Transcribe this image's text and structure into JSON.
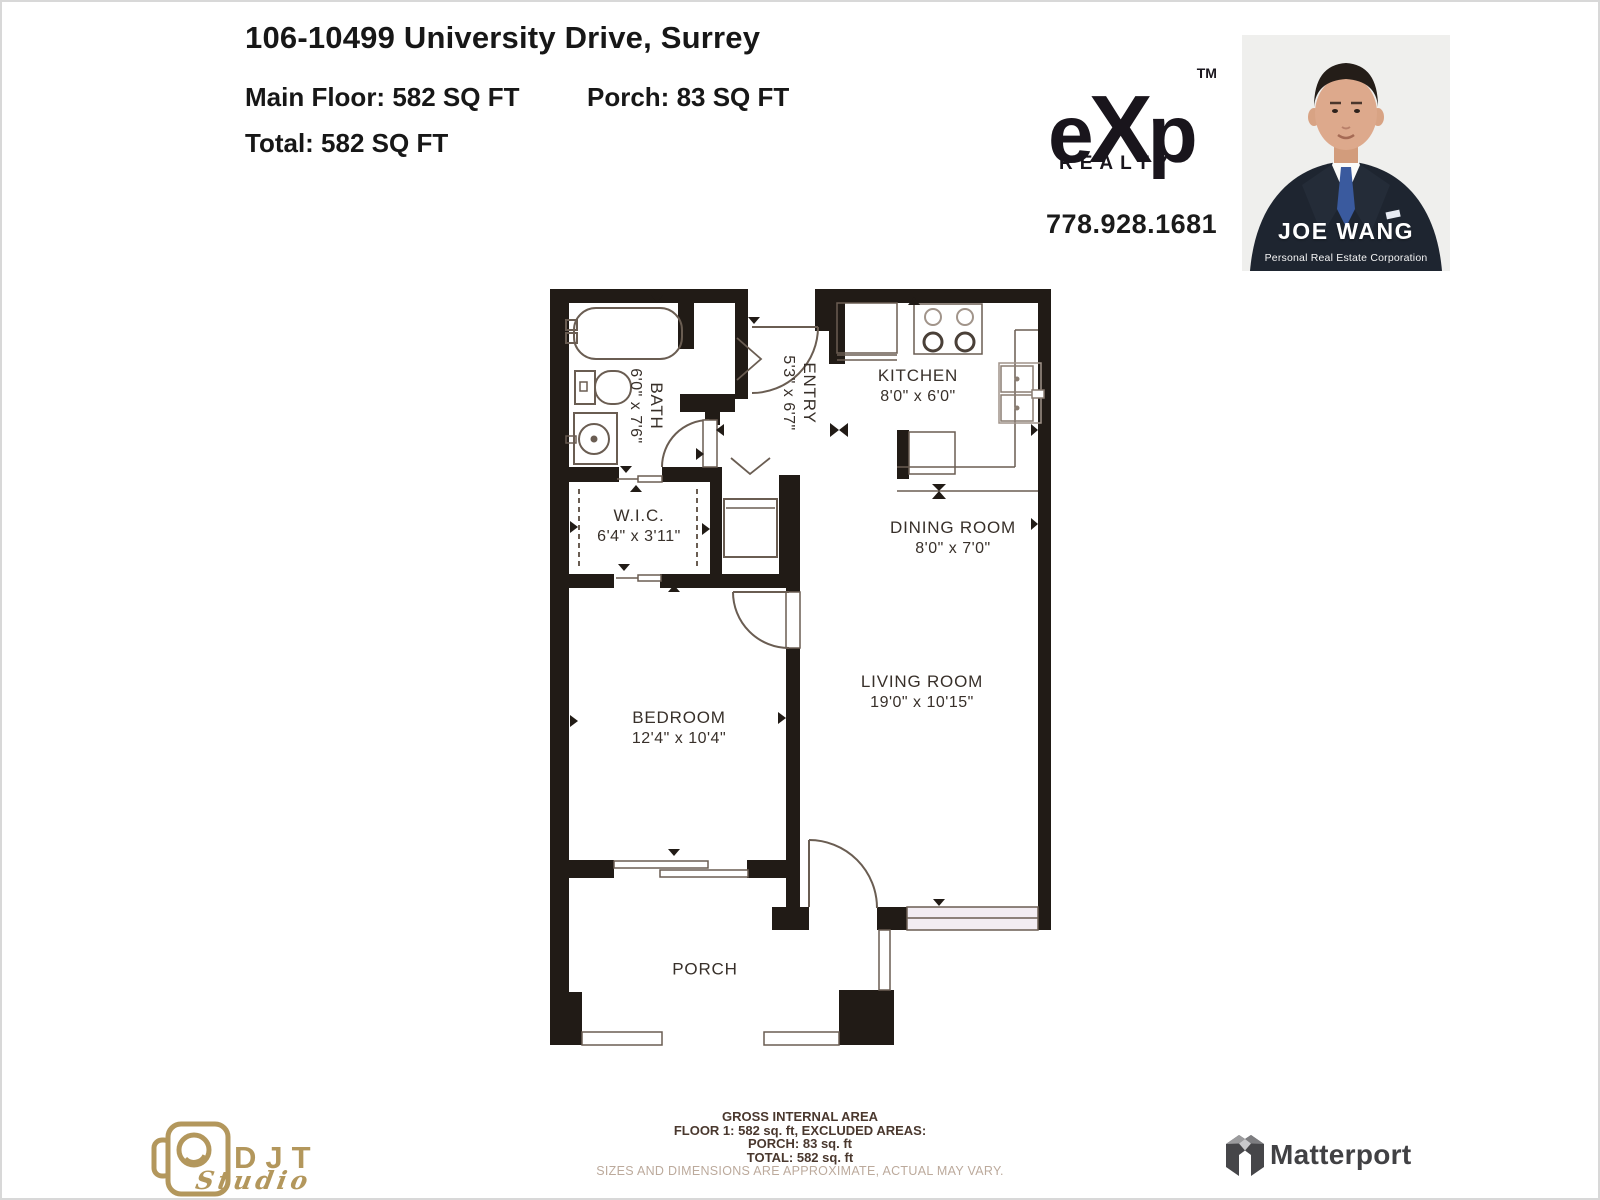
{
  "header": {
    "title": "106-10499 University Drive, Surrey",
    "main_floor": "Main Floor: 582 SQ FT",
    "porch": "Porch: 83 SQ FT",
    "total": "Total: 582 SQ FT"
  },
  "branding": {
    "exp": {
      "e": "e",
      "x": "X",
      "p": "p",
      "tm": "TM",
      "sub": "REALTY",
      "phone": "778.928.1681"
    },
    "agent": {
      "name": "JOE WANG",
      "subtitle": "Personal Real Estate Corporation"
    },
    "djt": {
      "name": "DJT",
      "sub": "Studio"
    },
    "matterport": {
      "name": "Matterport"
    }
  },
  "floorplan": {
    "rooms": [
      {
        "name": "KITCHEN",
        "dims": "8'0\" x 6'0\""
      },
      {
        "name": "DINING ROOM",
        "dims": "8'0\" x 7'0\""
      },
      {
        "name": "LIVING ROOM",
        "dims": "19'0\" x 10'15\""
      },
      {
        "name": "BEDROOM",
        "dims": "12'4\" x 10'4\""
      },
      {
        "name": "W.I.C.",
        "dims": "6'4\" x 3'11\""
      },
      {
        "name": "BATH",
        "dims": "6'0\" x 7'6\""
      },
      {
        "name": "ENTRY",
        "dims": "5'3\" x 6'7\""
      },
      {
        "name": "PORCH",
        "dims": ""
      }
    ]
  },
  "footer": {
    "line1": "GROSS INTERNAL AREA",
    "line2": "FLOOR 1: 582 sq. ft, EXCLUDED AREAS:",
    "line3": "PORCH: 83 sq. ft",
    "line4": "TOTAL: 582 sq. ft",
    "disclaimer": "SIZES AND DIMENSIONS ARE APPROXIMATE, ACTUAL MAY VARY."
  },
  "colors": {
    "wall": "#211b16",
    "fixture_line": "#6a5d52",
    "window_fill": "#f2ecf2",
    "label_text": "#38302a",
    "footer_text": "#4a382e",
    "disclaimer_text": "#bcaa9c",
    "gold": "#b3975c",
    "matterport_gray": "#414144",
    "suit_navy": "#1e2530",
    "tie_blue": "#3a5a9e"
  }
}
